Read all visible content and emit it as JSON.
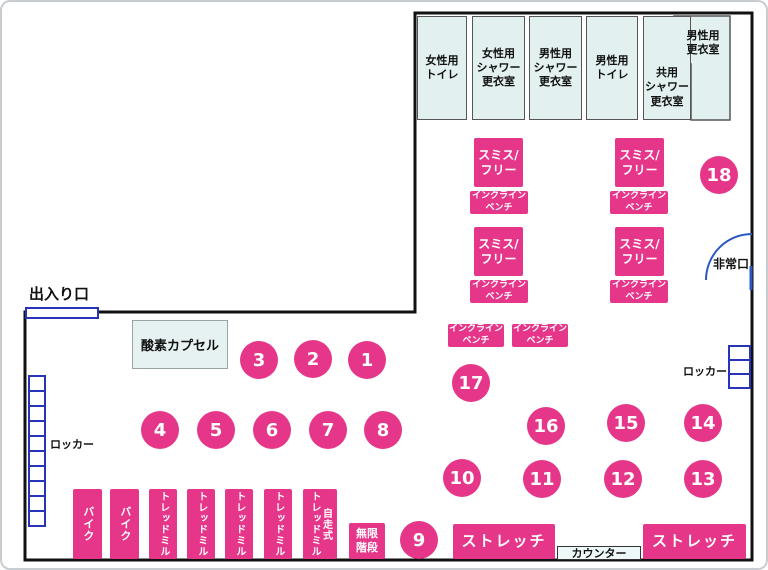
{
  "palette": {
    "pink": "#e5368a",
    "room_fill": "#e2f0ef",
    "wall": "#111111",
    "locker_blue": "#2733b8",
    "exit_arc_blue": "#2a58c0"
  },
  "rooms": [
    {
      "id": "womens-toilet",
      "label": "女性用\nトイレ"
    },
    {
      "id": "womens-shower-changing",
      "label": "女性用\nシャワー\n更衣室"
    },
    {
      "id": "mens-shower-changing",
      "label": "男性用\nシャワー\n更衣室"
    },
    {
      "id": "mens-toilet",
      "label": "男性用\nトイレ"
    },
    {
      "id": "shared-shower-changing",
      "label": "共用\nシャワー\n更衣室"
    },
    {
      "id": "mens-changing",
      "label": "男性用\n更衣室"
    }
  ],
  "facility": {
    "entrance": "出入り口",
    "emergency_exit": "非常口",
    "locker_left": "ロッカー",
    "locker_right": "ロッカー",
    "oxygen_capsule": "酸素カプセル",
    "counter": "カウンター"
  },
  "equipment": {
    "smith_free": "スミス/\nフリー",
    "incline_bench": "インクライン\nベンチ",
    "stretch": "ストレッチ",
    "bike": "バイク",
    "treadmill": "トレッドミル",
    "self_propelled_treadmill": "自走式\nトレッドミル",
    "infinite_stairs": "無限\n階段"
  },
  "stations": [
    "1",
    "2",
    "3",
    "4",
    "5",
    "6",
    "7",
    "8",
    "9",
    "10",
    "11",
    "12",
    "13",
    "14",
    "15",
    "16",
    "17",
    "18"
  ]
}
